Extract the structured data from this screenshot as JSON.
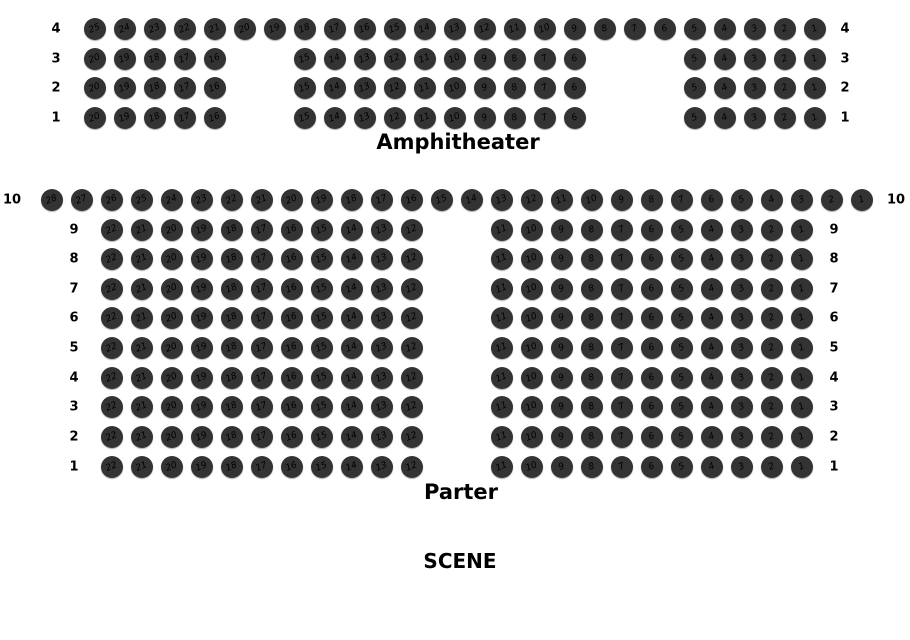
{
  "canvas": {
    "width": 910,
    "height": 640,
    "background": "#ffffff"
  },
  "seat_style": {
    "fill": "#333333",
    "number_color": "#000000",
    "diameter": 22,
    "spacing": 30,
    "number_rotation_deg": -22
  },
  "stage": {
    "label": "SCENE",
    "x": 460,
    "y": 561
  },
  "sections": [
    {
      "id": "amphitheater",
      "label": "Amphitheater",
      "label_x": 458,
      "label_y": 142,
      "rows": [
        {
          "label": "4",
          "y": 29,
          "left_label_x": 56,
          "right_label_x": 845,
          "blocks": [
            {
              "x": 95,
              "from": 25,
              "to": 1
            }
          ]
        },
        {
          "label": "3",
          "y": 59,
          "left_label_x": 56,
          "right_label_x": 845,
          "blocks": [
            {
              "x": 95,
              "from": 20,
              "to": 16
            },
            {
              "x": 305,
              "from": 15,
              "to": 6
            },
            {
              "x": 695,
              "from": 5,
              "to": 1
            }
          ]
        },
        {
          "label": "2",
          "y": 88,
          "left_label_x": 56,
          "right_label_x": 845,
          "blocks": [
            {
              "x": 95,
              "from": 20,
              "to": 16
            },
            {
              "x": 305,
              "from": 15,
              "to": 6
            },
            {
              "x": 695,
              "from": 5,
              "to": 1
            }
          ]
        },
        {
          "label": "1",
          "y": 118,
          "left_label_x": 56,
          "right_label_x": 845,
          "blocks": [
            {
              "x": 95,
              "from": 20,
              "to": 16
            },
            {
              "x": 305,
              "from": 15,
              "to": 6
            },
            {
              "x": 695,
              "from": 5,
              "to": 1
            }
          ]
        }
      ]
    },
    {
      "id": "parter",
      "label": "Parter",
      "label_x": 461,
      "label_y": 492,
      "rows": [
        {
          "label": "10",
          "y": 200,
          "left_label_x": 12,
          "right_label_x": 896,
          "blocks": [
            {
              "x": 52,
              "from": 28,
              "to": 1
            }
          ]
        },
        {
          "label": "9",
          "y": 230,
          "left_label_x": 74,
          "right_label_x": 834,
          "blocks": [
            {
              "x": 112,
              "from": 22,
              "to": 12
            },
            {
              "x": 502,
              "from": 11,
              "to": 1
            }
          ]
        },
        {
          "label": "8",
          "y": 259,
          "left_label_x": 74,
          "right_label_x": 834,
          "blocks": [
            {
              "x": 112,
              "from": 22,
              "to": 12
            },
            {
              "x": 502,
              "from": 11,
              "to": 1
            }
          ]
        },
        {
          "label": "7",
          "y": 289,
          "left_label_x": 74,
          "right_label_x": 834,
          "blocks": [
            {
              "x": 112,
              "from": 22,
              "to": 12
            },
            {
              "x": 502,
              "from": 11,
              "to": 1
            }
          ]
        },
        {
          "label": "6",
          "y": 318,
          "left_label_x": 74,
          "right_label_x": 834,
          "blocks": [
            {
              "x": 112,
              "from": 22,
              "to": 12
            },
            {
              "x": 502,
              "from": 11,
              "to": 1
            }
          ]
        },
        {
          "label": "5",
          "y": 348,
          "left_label_x": 74,
          "right_label_x": 834,
          "blocks": [
            {
              "x": 112,
              "from": 22,
              "to": 12
            },
            {
              "x": 502,
              "from": 11,
              "to": 1
            }
          ]
        },
        {
          "label": "4",
          "y": 378,
          "left_label_x": 74,
          "right_label_x": 834,
          "blocks": [
            {
              "x": 112,
              "from": 22,
              "to": 12
            },
            {
              "x": 502,
              "from": 11,
              "to": 1
            }
          ]
        },
        {
          "label": "3",
          "y": 407,
          "left_label_x": 74,
          "right_label_x": 834,
          "blocks": [
            {
              "x": 112,
              "from": 22,
              "to": 12
            },
            {
              "x": 502,
              "from": 11,
              "to": 1
            }
          ]
        },
        {
          "label": "2",
          "y": 437,
          "left_label_x": 74,
          "right_label_x": 834,
          "blocks": [
            {
              "x": 112,
              "from": 22,
              "to": 12
            },
            {
              "x": 502,
              "from": 11,
              "to": 1
            }
          ]
        },
        {
          "label": "1",
          "y": 467,
          "left_label_x": 74,
          "right_label_x": 834,
          "blocks": [
            {
              "x": 112,
              "from": 22,
              "to": 12
            },
            {
              "x": 502,
              "from": 11,
              "to": 1
            }
          ]
        }
      ]
    }
  ]
}
